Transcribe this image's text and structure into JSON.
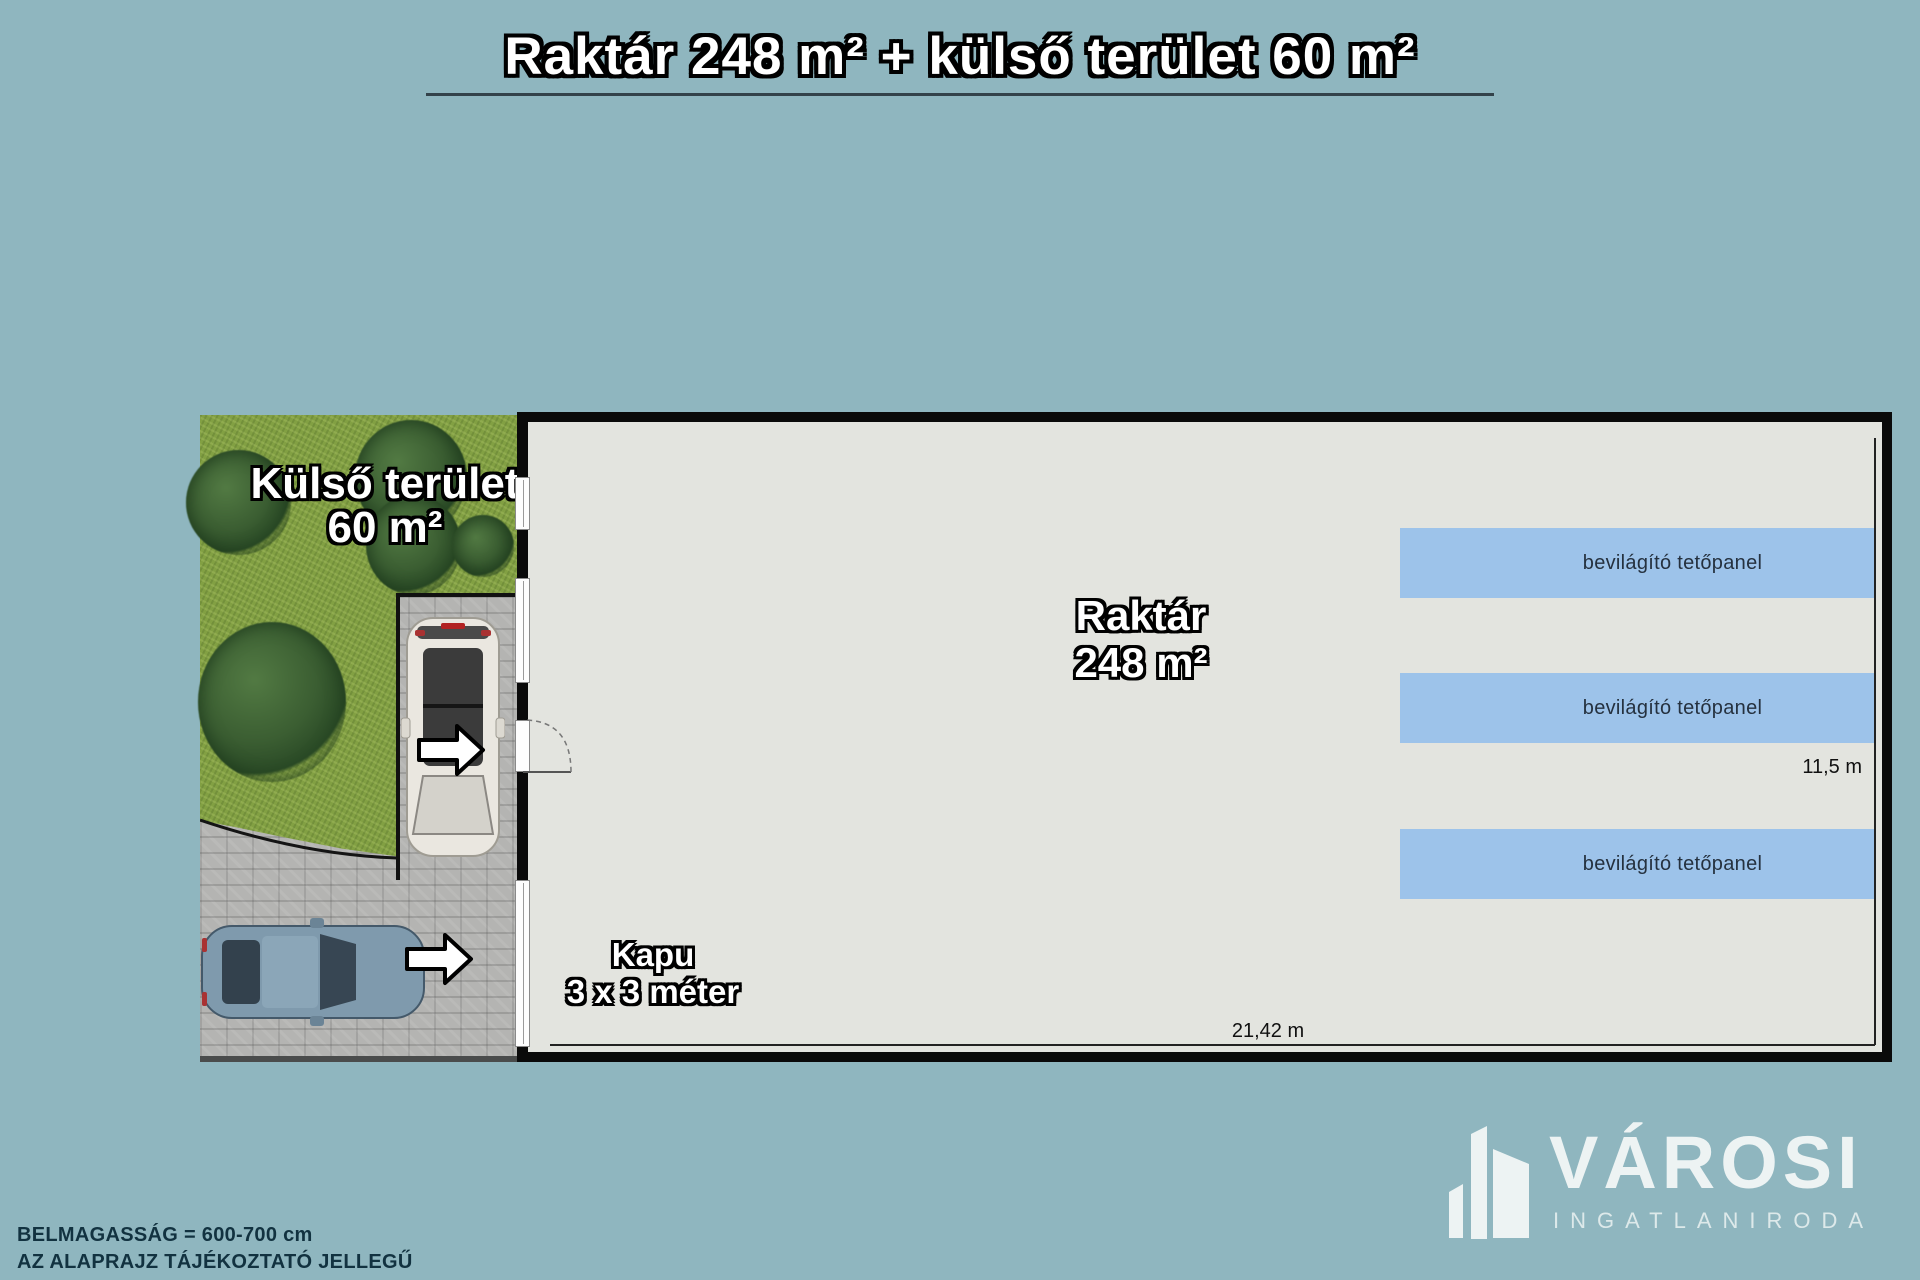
{
  "title": {
    "text": "Raktár 248 m² + külső terület 60 m²"
  },
  "outdoor_area": {
    "name_line": "Külső terület",
    "size_line": "60 m²"
  },
  "warehouse": {
    "name_line": "Raktár",
    "size_line": "248 m²"
  },
  "gate_label": {
    "name_line": "Kapu",
    "size_line": "3 x 3 méter"
  },
  "roof_panels": {
    "items": [
      {
        "label": "bevilágító tetőpanel"
      },
      {
        "label": "bevilágító tetőpanel"
      },
      {
        "label": "bevilágító tetőpanel"
      }
    ]
  },
  "dimensions": {
    "interior_width": "21,42 m",
    "interior_depth": "11,5 m"
  },
  "notes": {
    "line1": "BELMAGASSÁG = 600-700 cm",
    "line2": "AZ ALAPRAJZ TÁJÉKOZTATÓ JELLEGŰ"
  },
  "brand": {
    "name": "VÁROSI",
    "subtitle": "INGATLANIRODA"
  },
  "colors": {
    "background": "#8fb6bf",
    "floor": "#e3e4df",
    "panel_blue": "#9dc3ea",
    "grass": "#82a043",
    "wall": "#0a0a0a"
  }
}
